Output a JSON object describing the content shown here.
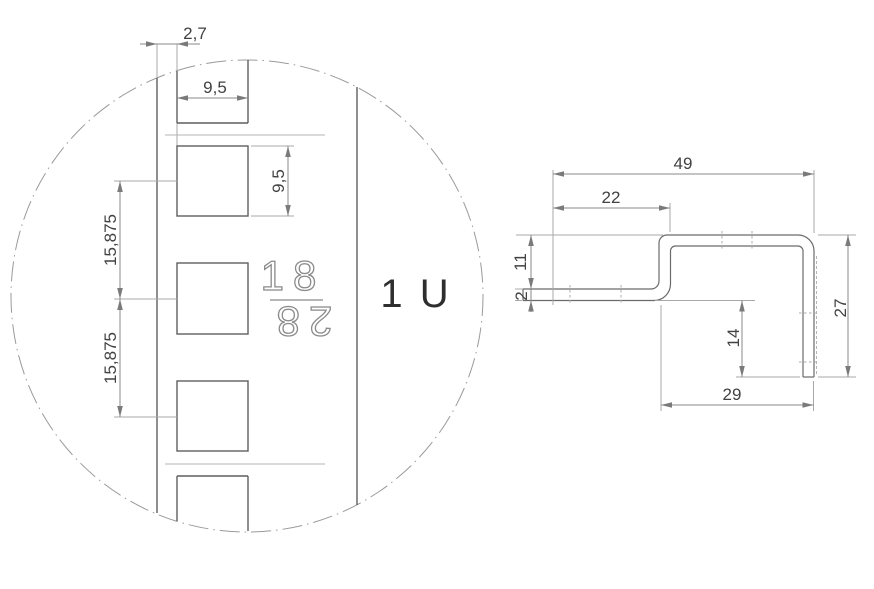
{
  "title": "Rack rail detail and mounting bracket profile drawing",
  "detail_view": {
    "unit_label": "1 U",
    "marking": {
      "top": "18",
      "bottom": "28"
    },
    "dimensions": {
      "edge_offset": "2,7",
      "hole_width": "9,5",
      "hole_height": "9,5",
      "hole_pitch_upper": "15,875",
      "hole_pitch_lower": "15,875"
    }
  },
  "profile_view": {
    "dimensions": {
      "overall_width": "49",
      "upper_flange_length": "22",
      "step_height": "11",
      "sheet_thickness": "2",
      "leg_height": "14",
      "overall_height": "27",
      "lower_width": "29"
    }
  },
  "colors": {
    "background": "#ffffff",
    "object_line": "#5f5f5f",
    "dimension_line": "#8a8a8a",
    "extension_line": "#a8a8a8",
    "light_line": "#b4b4b4",
    "dimension_text": "#424242",
    "label_text": "#2e2e2e"
  }
}
